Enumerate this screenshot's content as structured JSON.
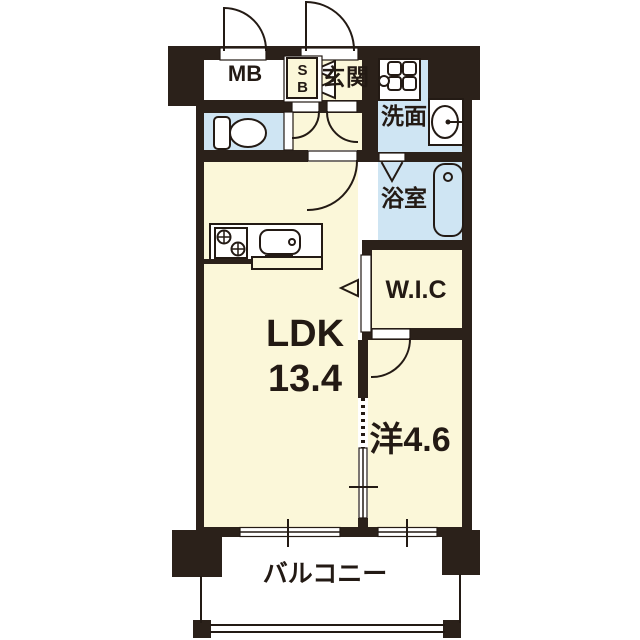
{
  "floorplan": {
    "title": "apartment-floor-plan",
    "rooms": {
      "mb": {
        "label": "MB"
      },
      "sb": {
        "label": "SB"
      },
      "genkan": {
        "label": "玄関"
      },
      "senmen": {
        "label": "洗面"
      },
      "yokushitsu": {
        "label": "浴室"
      },
      "wic": {
        "label": "W.I.C"
      },
      "ldk": {
        "name": "LDK",
        "size": "13.4"
      },
      "yoshitsu": {
        "label": "洋4.6"
      },
      "balcony": {
        "label": "バルコニー"
      }
    },
    "colors": {
      "wall": "#2b211a",
      "room_cream": "#fbf7d9",
      "room_blue": "#cfe5f3",
      "line": "#231a14",
      "background": "#ffffff"
    },
    "icons": {
      "toilet": "toilet-icon",
      "washer_pan": "washing-machine-pan-icon",
      "wash_basin": "wash-basin-icon",
      "bathtub": "bathtub-icon",
      "stove": "stove-burners-icon",
      "kitchen_sink": "kitchen-sink-icon",
      "doors": "door-swing-arc-icon",
      "folding_door": "folding-door-icon",
      "sliding_arrow": "sliding-door-arrow-icon"
    }
  }
}
